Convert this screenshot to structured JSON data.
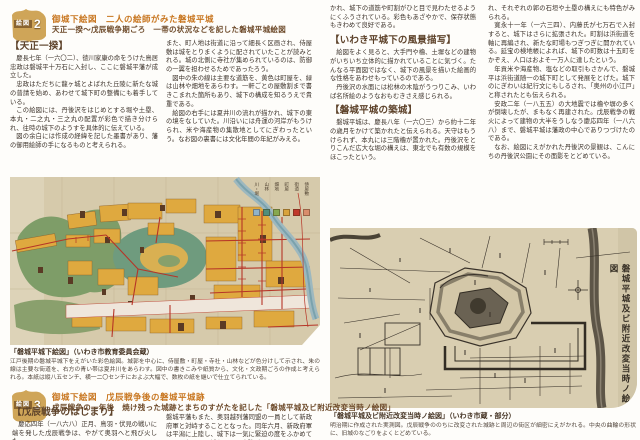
{
  "colors": {
    "accent_orange": "#c8761f",
    "title_brown": "#6d4a2a",
    "badge_gold": "#cfa558",
    "body_text": "#3d332b"
  },
  "section2": {
    "badge": {
      "label": "絵図",
      "number": "2"
    },
    "title_line1": "御城下絵図　二人の絵師がみた磐城平城",
    "title_line2": "天正一揆〜戊辰戦争期ごろ　一帯の状況などを記した磐城平城絵図",
    "col1": {
      "heading": "【天正一揆】",
      "paragraphs": [
        "慶長七年（一六〇二）、徳川家康の命をうけた鳥居忠政は磐城平十万石に入封し、ここに磐城平藩が成立した。",
        "忠政はただちに龍ヶ城とよばれた丘陵に新たな城の普請を始め、あわせて城下町の整備にも着手している。",
        "この絵図には、丹後沢をはじめとする堀や土塁、本丸・二之丸・三之丸の配置が彩色で描き分けられ、往時の城下のようすを具体的に伝えている。",
        "図の余白には作成の経緯を記した墨書があり、藩の御用絵師の手になるものと考えられる。"
      ]
    },
    "col2": {
      "paragraphs": [
        "また、町人地は街道に沿って細長く区画され、侍屋敷は城をとりまくように配されていたことが読みとれる。城の北側に寺社が集められているのは、防御の一翼を担わせるためであったろう。",
        "図中の朱の線は主要な道筋を、黄色は町屋を、緑は山林や畑地をあらわす。一軒ごとの屋敷割まで書きこまれた箇所もあり、城下の構成を知るうえで貴重である。",
        "絵図の右手には夏井川の流れが描かれ、城下の東の境をなしていた。川沿いには舟運の河岸がもうけられ、米や海産物の集散地としてにぎわったという。なお図の裏書には文化年間の年紀がみえる。"
      ]
    },
    "col3": {
      "lead": "かれ、城下の道筋や町割がひと目で見わたせるようにくふうされている。彩色もあざやかで、保存状態もきわめて良好である。",
      "heading1": "【いわき平城下の風景描写】",
      "paragraphs1": [
        "絵図をよく見ると、大手門や櫓、土塀などの建物がいちいち立体的に描かれていることに気づく。たんなる平面図ではなく、城下の風景を描いた絵画的な性格をあわせもっているのである。",
        "丹後沢の水面には松林の木陰がうつりこみ、いわば名所絵のようなおもむきさえ感じられる。"
      ],
      "heading2": "【磐城平城の築城】",
      "paragraphs2": [
        "磐城平城は、慶長八年（一六〇三）から約十二年の歳月をかけて築かれたと伝えられる。天守はもうけられず、本丸には三階櫓が置かれた。丹後沢をとりこんだ広大な堀の構えは、東北でも有数の規模をほこったという。"
      ]
    },
    "col4": {
      "paragraphs": [
        "れ、それぞれの郭の石垣や土塁の構えにも特色がみられる。",
        "寛永十一年（一六三四）、内藤氏が七万石で入封すると、城下はさらに拡張された。町割は浜街道を軸に再編され、新たな町場もつぎつぎに開かれている。延宝の検地帳によれば、城下の町数は十五町をかぞえ、人口はおよそ一万人に達したという。",
        "年貢米や海産物、塩などの取引もさかんで、磐城平は浜街道随一の城下町として発展をとげた。城下のにぎわいは紀行文にもしるされ、「奥州の小江戸」と称されたとも伝えられる。",
        "安政二年（一八五五）の大地震では櫓や塀の多くが倒壊したが、まもなく再建された。戊辰戦争の戦火によって建物の大半をうしなう慶応四年（一八六八）まで、磐城平城は藩政の中心でありつづけたのである。",
        "なお、絵図にえがかれた丹後沢の景観は、こんにちの丹後沢公園にその面影をとどめている。"
      ]
    }
  },
  "left_map": {
    "legend": {
      "items": [
        {
          "label": "川・堀",
          "color": "#8fb3c9"
        },
        {
          "label": "山林",
          "color": "#4f8f7c"
        },
        {
          "label": "畑地",
          "color": "#86a84f"
        },
        {
          "label": "町屋",
          "color": "#d9a33c"
        },
        {
          "label": "街道",
          "color": "#c0392b"
        },
        {
          "label": "侍屋敷",
          "color": "#d98d6c"
        }
      ]
    },
    "caption_title": "「磐城平城下絵図」（いわき市教育委員会蔵）",
    "caption_body": "江戸後期の磐城平城下をえがいた彩色絵図。城郭を中心に、侍屋敷・町屋・寺社・山林などが色分けして示され、朱の線は主要な街道を、右方の青い帯は夏井川をあらわす。図中の書きこみや紙質から、文化・文政期ごろの作成と考えられる。本紙は縦八五センチ、横一二〇センチにおよぶ大幅で、数枚の紙を継いで仕立てられている。"
  },
  "right_map": {
    "vertical_title": "磐城平城及ビ附近改変当時ノ絵図",
    "caption_title": "「磐城平城及ビ附近改変当時ノ絵図」（いわき市蔵・部分）",
    "caption_body": "明治期に作成された実測図。戊辰戦争ののちに改変された城跡と周辺の街区が細密にえがかれる。中央の曲輪の形状に、旧城のなごりをよくとどめている。"
  },
  "section3": {
    "badge": {
      "label": "絵図",
      "number": "3"
    },
    "title_line1": "御城下絵図　戊辰戦争後の磐城平城跡",
    "title_line2": "戊辰戦争の一年後　焼け残った城跡とまちのすがたを記した「磐城平城及ビ附近改変当時ノ絵図」",
    "heading": "【戊辰戦争のはじまり】",
    "colA_paragraphs": [
      "慶応四年（一八六八）正月、鳥羽・伏見の戦いに端を発した戊辰戦争は、やがて奥羽へと飛び火した。"
    ],
    "colB_paragraphs": [
      "磐城平藩もまた、奥羽越列藩同盟の一員として新政府軍と対峙することとなった。同年六月、新政府軍は平潟に上陸し、城下は一気に緊迫の度をふかめていく。七月には城をめぐる攻防がはじまった。"
    ]
  }
}
